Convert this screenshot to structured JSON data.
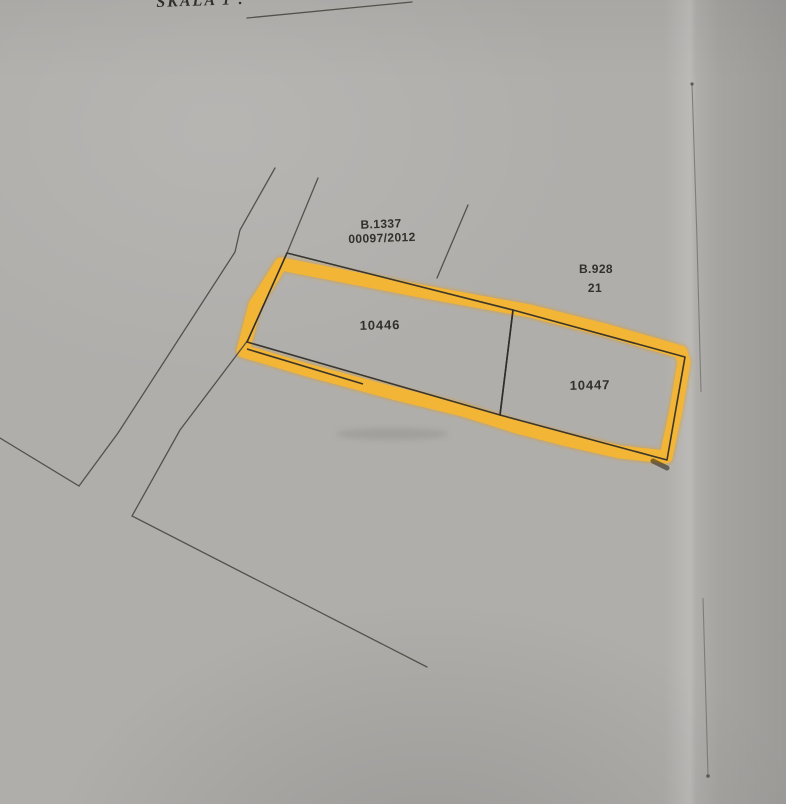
{
  "photo": {
    "scale_label": "SKALA 1 :",
    "region_upper": {
      "code": "B.1337",
      "number": "00097/2012"
    },
    "region_right": {
      "code": "B.928",
      "number": "21"
    },
    "parcels": [
      {
        "id": "10446",
        "highlighted": true
      },
      {
        "id": "10447",
        "highlighted": true
      }
    ],
    "colors": {
      "paper": "#b0aeab",
      "ink": "#44413c",
      "boundary": "#2f2c27",
      "highlight": "#f4b533",
      "highlight_edge": "#de9c24",
      "text": "#33302b",
      "crease": "#73716d"
    }
  }
}
